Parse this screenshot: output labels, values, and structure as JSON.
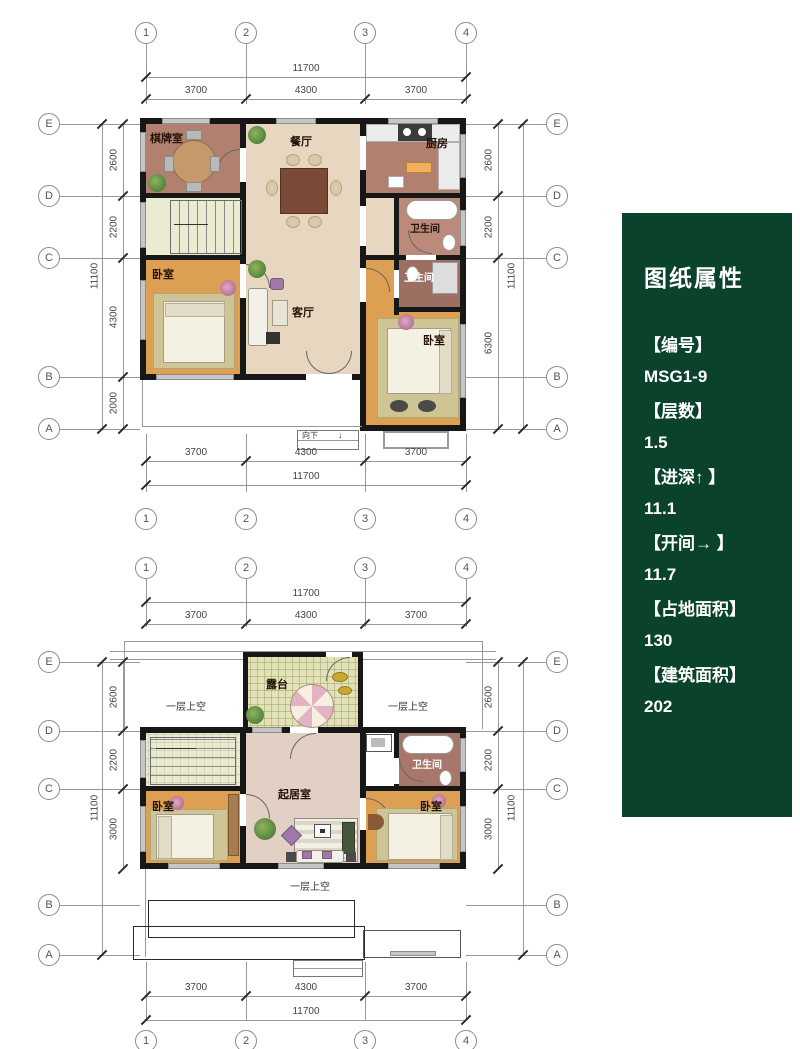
{
  "panel": {
    "title": "图纸属性",
    "accent_color": "#0a422c",
    "fields": [
      {
        "label": "【编号】",
        "value": "MSG1-9"
      },
      {
        "label": "【层数】",
        "value": "1.5"
      },
      {
        "label": "【进深↑ 】",
        "value": "11.1"
      },
      {
        "label": "【开间→ 】",
        "value": "11.7"
      },
      {
        "label": "【占地面积】",
        "value": "130"
      },
      {
        "label": "【建筑面积】",
        "value": "202"
      }
    ]
  },
  "grid": {
    "cols": [
      "1",
      "2",
      "3",
      "4"
    ],
    "rows": [
      "E",
      "D",
      "C",
      "B",
      "A"
    ],
    "width_total": "11700",
    "width_segments": [
      "3700",
      "4300",
      "3700"
    ],
    "depth_total": "11100"
  },
  "plan1": {
    "depth_segments_left": [
      "2600",
      "2200",
      "4300",
      "2000"
    ],
    "depth_segments_right": [
      "2600",
      "2200",
      "6300"
    ],
    "rooms": {
      "chess": "棋牌室",
      "dining": "餐厅",
      "kitchen": "厨房",
      "bath_top": "卫生间",
      "bath_mid": "卫生间",
      "bed_left": "卧室",
      "living": "客厅",
      "bed_right": "卧室"
    },
    "entry_note": "向下"
  },
  "plan2": {
    "depth_segments_left": [
      "2600",
      "2200",
      "3000"
    ],
    "depth_segments_right": [
      "2600",
      "2200",
      "3000"
    ],
    "rooms": {
      "terrace": "露台",
      "void_left": "一层上空",
      "void_right": "一层上空",
      "bath": "卫生间",
      "family": "起居室",
      "bed_left": "卧室",
      "bed_right": "卧室",
      "void_bottom": "一层上空"
    }
  }
}
